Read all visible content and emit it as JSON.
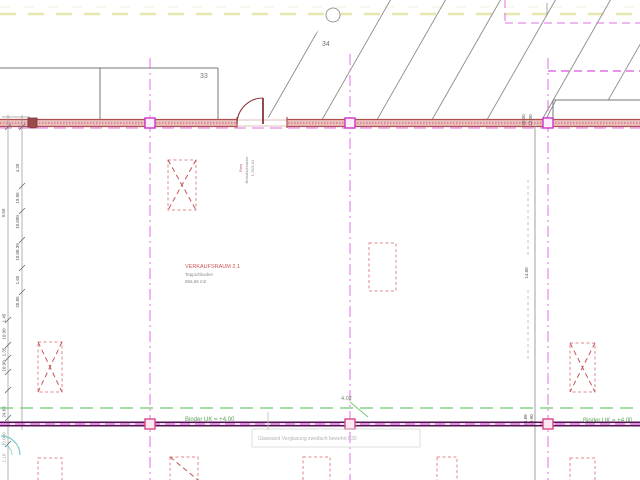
{
  "drawing": {
    "room_labels": {
      "room_33": "33",
      "room_34": "34"
    },
    "room_label": {
      "title": "VERKAUFSRAUM 2.1",
      "floor": "Teppichboden",
      "area": "865,56 m2"
    },
    "door_note": {
      "l1": "Rwa",
      "l2": "Brandschutztor",
      "l3": "1,76/2,01"
    },
    "binder": {
      "left": "Binder UK = +4.00",
      "right": "Binder UK = +4.00"
    },
    "facade": {
      "dim": "4.02",
      "note": "Glaswand Verglasung zweifach bewehrt F30"
    },
    "dims_left": [
      "4.26",
      "19.06",
      "10.690",
      "10.08.39",
      "1.65",
      "26.85",
      "9.50",
      "1.45",
      "10.90",
      "1.35",
      "10.90",
      "24.88",
      "9.000",
      "1.10"
    ],
    "dims_right": [
      "40.00",
      "12.00",
      "14.60",
      "24.88",
      "10.90"
    ],
    "colors": {
      "wall_red": "#b05050",
      "grid_magenta": "#e070e0",
      "facade_purple": "#5a1055",
      "ground_green": "#72c872",
      "reference_yellow": "#e6e6ae",
      "column_red": "#e08888",
      "hatch_gray": "#8a8a8a",
      "note_cyan": "#7ccaca"
    }
  }
}
